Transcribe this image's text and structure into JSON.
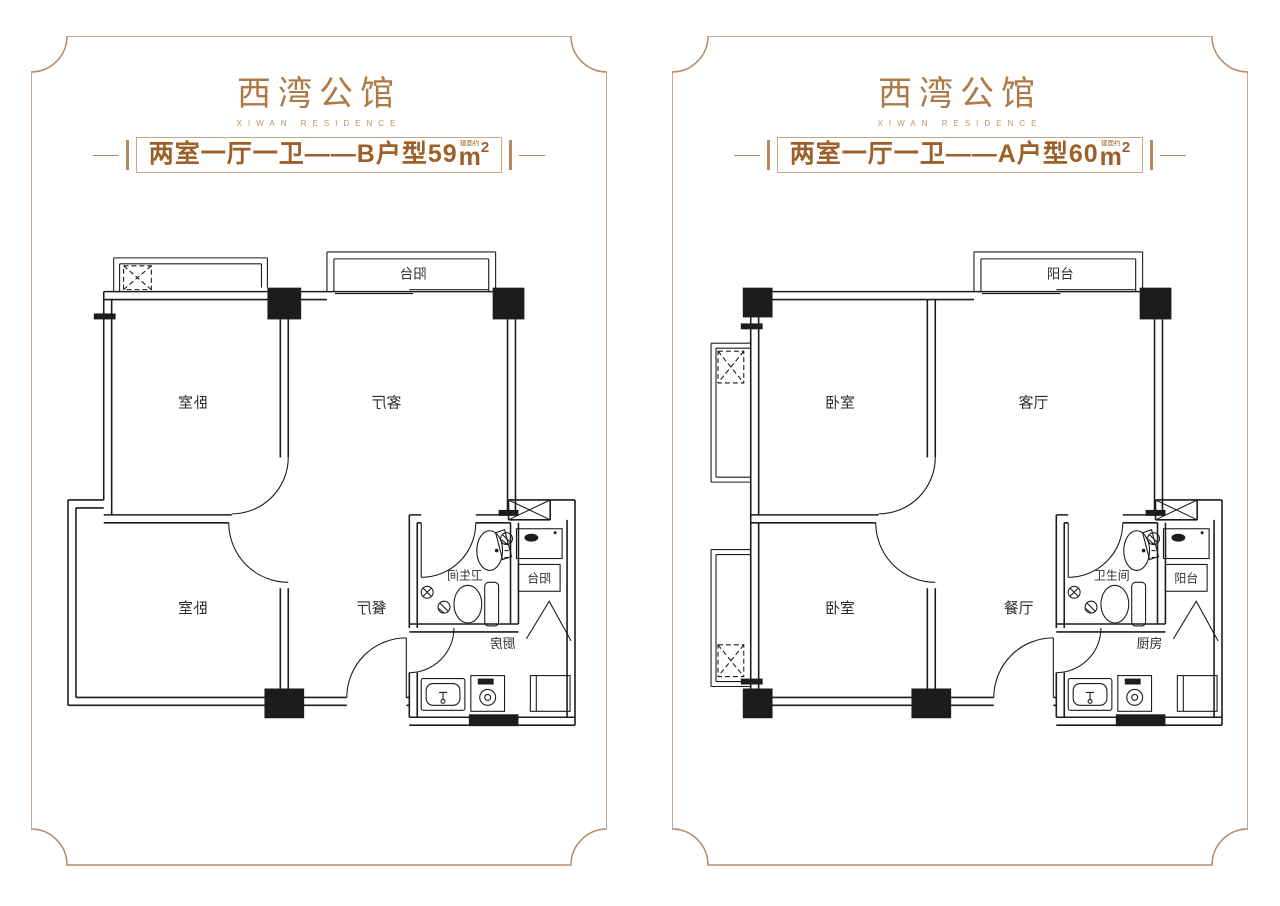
{
  "colors": {
    "accent_title": "#ae7946",
    "accent_sub": "#bd9166",
    "banner_text": "#9d6128",
    "banner_border": "#c9a87f",
    "frame_line": "#b48a66",
    "plan_line": "#1c1c1c"
  },
  "brand": {
    "title": "西湾公馆",
    "subtitle": "XIWAN RESIDENCE"
  },
  "panels": [
    {
      "unit_type": "B",
      "banner": {
        "main": "两室一厅一卫——B户型59",
        "area_note": "建面约",
        "unit": "m",
        "exp": "2"
      },
      "rooms": {
        "bedroom_top": "卧室",
        "living": "客厅",
        "bedroom_bottom": "卧室",
        "dining": "餐厅",
        "bathroom": "卫生间",
        "kitchen": "厨房",
        "balcony": "阳台",
        "balcony_small": "阳台"
      },
      "labels_mirrored": true
    },
    {
      "unit_type": "A",
      "banner": {
        "main": "两室一厅一卫——A户型60",
        "area_note": "建面约",
        "unit": "m",
        "exp": "2"
      },
      "rooms": {
        "bedroom_top": "卧室",
        "living": "客厅",
        "bedroom_bottom": "卧室",
        "dining": "餐厅",
        "bathroom": "卫生间",
        "kitchen": "厨房",
        "balcony": "阳台",
        "balcony_small": "阳台"
      },
      "labels_mirrored": false
    }
  ]
}
